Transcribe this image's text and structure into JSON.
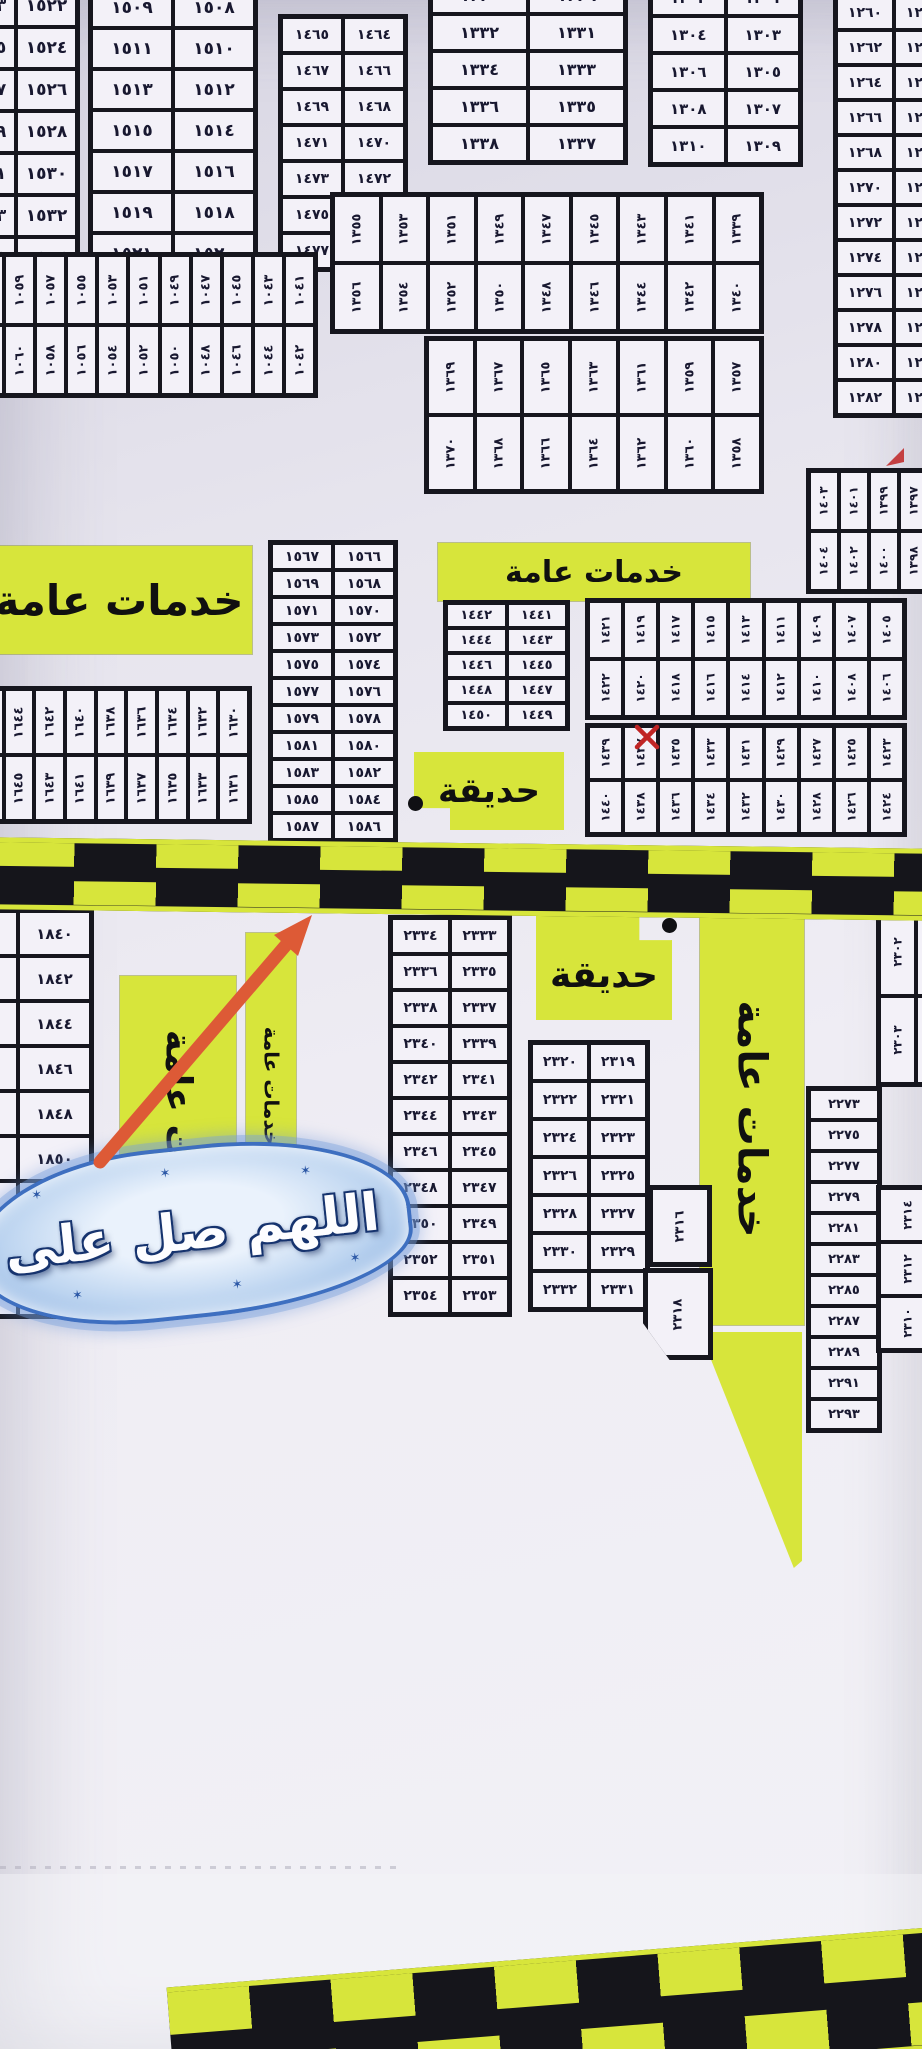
{
  "labels": {
    "public_services": "خدمات عامة",
    "garden": "حديقة",
    "calligraphy": "اللهم صل على"
  },
  "colors": {
    "paper": "#e8e6ef",
    "cell": "#f3f1f8",
    "line": "#16161e",
    "highlight": "#d7e53b",
    "road": "#15151b",
    "arrow": "#dd5a36",
    "red_mark": "#c02525",
    "calligraphy_blue": "#3e6fc0"
  },
  "plots": {
    "b1522": {
      "rows": [
        [
          "١٥٢٣",
          "١٥٢٢"
        ],
        [
          "١٥٢٥",
          "١٥٢٤"
        ],
        [
          "١٥٢٧",
          "١٥٢٦"
        ],
        [
          "١٥٢٩",
          "١٥٢٨"
        ],
        [
          "١٥٣١",
          "١٥٣٠"
        ],
        [
          "١٥٣٣",
          "١٥٣٢"
        ],
        [
          "١٥٣٥",
          "١٥٣٤"
        ]
      ]
    },
    "b1508": {
      "rows": [
        [
          "١٥٠٩",
          "١٥٠٨"
        ],
        [
          "١٥١١",
          "١٥١٠"
        ],
        [
          "١٥١٣",
          "١٥١٢"
        ],
        [
          "١٥١٥",
          "١٥١٤"
        ],
        [
          "١٥١٧",
          "١٥١٦"
        ],
        [
          "١٥١٩",
          "١٥١٨"
        ],
        [
          "١٥٢١",
          "١٥٢٠"
        ]
      ]
    },
    "b1464": {
      "rows": [
        [
          "١٤٦٥",
          "١٤٦٤"
        ],
        [
          "١٤٦٧",
          "١٤٦٦"
        ],
        [
          "١٤٦٩",
          "١٤٦٨"
        ],
        [
          "١٤٧١",
          "١٤٧٠"
        ],
        [
          "١٤٧٣",
          "١٤٧٢"
        ],
        [
          "١٤٧٥",
          "١٤٧٤"
        ],
        [
          "١٤٧٧",
          "١٤٧٦"
        ]
      ]
    },
    "b1329": {
      "rows": [
        [
          "١٣٣٠",
          "١٣٢٩"
        ],
        [
          "١٣٣٢",
          "١٣٣١"
        ],
        [
          "١٣٣٤",
          "١٣٣٣"
        ],
        [
          "١٣٣٦",
          "١٣٣٥"
        ],
        [
          "١٣٣٨",
          "١٣٣٧"
        ]
      ]
    },
    "b1301": {
      "rows": [
        [
          "١٣٠٢",
          "١٣٠١"
        ],
        [
          "١٣٠٤",
          "١٣٠٣"
        ],
        [
          "١٣٠٦",
          "١٣٠٥"
        ],
        [
          "١٣٠٨",
          "١٣٠٧"
        ],
        [
          "١٣١٠",
          "١٣٠٩"
        ]
      ]
    },
    "b1259": {
      "rows": [
        [
          "١٢٦٠",
          "١٢٥٩"
        ],
        [
          "١٢٦٢",
          "١٢٦١"
        ],
        [
          "١٢٦٤",
          "١٢٦٣"
        ],
        [
          "١٢٦٦",
          "١٢٦٥"
        ],
        [
          "١٢٦٨",
          "١٢٦٧"
        ],
        [
          "١٢٧٠",
          "١٢٦٩"
        ],
        [
          "١٢٧٢",
          "١٢٧١"
        ],
        [
          "١٢٧٤",
          "١٢٧٣"
        ],
        [
          "١٢٧٦",
          "١٢٧٥"
        ],
        [
          "١٢٧٨",
          "١٢٧٧"
        ],
        [
          "١٢٨٠",
          "١٢٧٩"
        ],
        [
          "١٢٨٢",
          "١٢٨١"
        ]
      ]
    },
    "s1040": {
      "rows": [
        [
          "١٠٦١",
          "١٠٥٩",
          "١٠٥٧",
          "١٠٥٥",
          "١٠٥٣",
          "١٠٥١",
          "١٠٤٩",
          "١٠٤٧",
          "١٠٤٥",
          "١٠٤٣",
          "١٠٤١"
        ],
        [
          "١٠٦٢",
          "١٠٦٠",
          "١٠٥٨",
          "١٠٥٦",
          "١٠٥٤",
          "١٠٥٢",
          "١٠٥٠",
          "١٠٤٨",
          "١٠٤٦",
          "١٠٤٤",
          "١٠٤٢"
        ]
      ]
    },
    "s1339": {
      "rows": [
        [
          "١٣٥٥",
          "١٣٥٣",
          "١٣٥١",
          "١٣٤٩",
          "١٣٤٧",
          "١٣٤٥",
          "١٣٤٣",
          "١٣٤١",
          "١٣٣٩"
        ],
        [
          "١٣٥٦",
          "١٣٥٤",
          "١٣٥٢",
          "١٣٥٠",
          "١٣٤٨",
          "١٣٤٦",
          "١٣٤٤",
          "١٣٤٢",
          "١٣٤٠"
        ]
      ]
    },
    "s1357": {
      "rows": [
        [
          "١٣٦٩",
          "١٣٦٧",
          "١٣٦٥",
          "١٣٦٣",
          "١٣٦١",
          "١٣٥٩",
          "١٣٥٧"
        ],
        [
          "١٣٧٠",
          "١٣٦٨",
          "١٣٦٦",
          "١٣٦٤",
          "١٣٦٢",
          "١٣٦٠",
          "١٣٥٨"
        ]
      ]
    },
    "b1397": {
      "rows": [
        [
          "١٤٠٣",
          "١٤٠١",
          "١٣٩٩",
          "١٣٩٧"
        ],
        [
          "١٤٠٤",
          "١٤٠٢",
          "١٤٠٠",
          "١٣٩٨"
        ]
      ]
    },
    "b1566": {
      "rows": [
        [
          "١٥٦٧",
          "١٥٦٦"
        ],
        [
          "١٥٦٩",
          "١٥٦٨"
        ],
        [
          "١٥٧١",
          "١٥٧٠"
        ],
        [
          "١٥٧٣",
          "١٥٧٢"
        ],
        [
          "١٥٧٥",
          "١٥٧٤"
        ],
        [
          "١٥٧٧",
          "١٥٧٦"
        ],
        [
          "١٥٧٩",
          "١٥٧٨"
        ],
        [
          "١٥٨١",
          "١٥٨٠"
        ],
        [
          "١٥٨٣",
          "١٥٨٢"
        ],
        [
          "١٥٨٥",
          "١٥٨٤"
        ],
        [
          "١٥٨٧",
          "١٥٨٦"
        ]
      ]
    },
    "b1441": {
      "rows": [
        [
          "١٤٤٢",
          "١٤٤١"
        ],
        [
          "١٤٤٤",
          "١٤٤٣"
        ],
        [
          "١٤٤٦",
          "١٤٤٥"
        ],
        [
          "١٤٤٨",
          "١٤٤٧"
        ],
        [
          "١٤٥٠",
          "١٤٤٩"
        ]
      ]
    },
    "s1405": {
      "rows": [
        [
          "١٤٢١",
          "١٤١٩",
          "١٤١٧",
          "١٤١٥",
          "١٤١٣",
          "١٤١١",
          "١٤٠٩",
          "١٤٠٧",
          "١٤٠٥"
        ],
        [
          "١٤٢٢",
          "١٤٢٠",
          "١٤١٨",
          "١٤١٦",
          "١٤١٤",
          "١٤١٢",
          "١٤١٠",
          "١٤٠٨",
          "١٤٠٦"
        ]
      ]
    },
    "s1423": {
      "rows": [
        [
          "١٤٣٩",
          "١٤٣٧",
          "١٤٣٥",
          "١٤٣٣",
          "١٤٣١",
          "١٤٢٩",
          "١٤٢٧",
          "١٤٢٥",
          "١٤٢٣"
        ],
        [
          "١٤٤٠",
          "١٤٣٨",
          "١٤٣٦",
          "١٤٣٤",
          "١٤٣٢",
          "١٤٣٠",
          "١٤٢٨",
          "١٤٢٦",
          "١٤٢٤"
        ]
      ]
    },
    "s1630": {
      "rows": [
        [
          "١٦٤٦",
          "١٦٤٤",
          "١٦٤٢",
          "١٦٤٠",
          "١٦٣٨",
          "١٦٣٦",
          "١٦٣٤",
          "١٦٣٢",
          "١٦٣٠"
        ],
        [
          "١٦٤٧",
          "١٦٤٥",
          "١٦٤٣",
          "١٦٤١",
          "١٦٣٩",
          "١٦٣٧",
          "١٦٣٥",
          "١٦٣٣",
          "١٦٣١"
        ]
      ]
    },
    "b1840": {
      "rows": [
        [
          "١٨٤١",
          "١٨٤٠"
        ],
        [
          "١٨٤٣",
          "١٨٤٢"
        ],
        [
          "١٨٤٥",
          "١٨٤٤"
        ],
        [
          "١٨٤٧",
          "١٨٤٦"
        ],
        [
          "١٨٤٩",
          "١٨٤٨"
        ],
        [
          "١٨٥١",
          "١٨٥٠"
        ],
        [
          "١٨٥٣",
          "١٨٥٢"
        ],
        [
          "١٨٥٥",
          "١٨٥٤"
        ],
        [
          "١٨٥٧",
          "١٨٥٦"
        ]
      ]
    },
    "b2333": {
      "rows": [
        [
          "٢٣٣٤",
          "٢٣٣٣"
        ],
        [
          "٢٣٣٦",
          "٢٣٣٥"
        ],
        [
          "٢٣٣٨",
          "٢٣٣٧"
        ],
        [
          "٢٣٤٠",
          "٢٣٣٩"
        ],
        [
          "٢٣٤٢",
          "٢٣٤١"
        ],
        [
          "٢٣٤٤",
          "٢٣٤٣"
        ],
        [
          "٢٣٤٦",
          "٢٣٤٥"
        ],
        [
          "٢٣٤٨",
          "٢٣٤٧"
        ],
        [
          "٢٣٥٠",
          "٢٣٤٩"
        ],
        [
          "٢٣٥٢",
          "٢٣٥١"
        ],
        [
          "٢٣٥٤",
          "٢٣٥٣"
        ]
      ]
    },
    "b2319": {
      "rows": [
        [
          "٢٣٢٠",
          "٢٣١٩"
        ],
        [
          "٢٣٢٢",
          "٢٣٢١"
        ],
        [
          "٢٣٢٤",
          "٢٣٢٣"
        ],
        [
          "٢٣٢٦",
          "٢٣٢٥"
        ],
        [
          "٢٣٢٨",
          "٢٣٢٧"
        ],
        [
          "٢٣٣٠",
          "٢٣٢٩"
        ],
        [
          "٢٣٣٢",
          "٢٣٣١"
        ]
      ]
    },
    "c2273": {
      "cells": [
        "٢٢٧٣",
        "٢٢٧٥",
        "٢٢٧٧",
        "٢٢٧٩",
        "٢٢٨١",
        "٢٢٨٣",
        "٢٢٨٥",
        "٢٢٨٧",
        "٢٢٨٩",
        "٢٢٩١",
        "٢٢٩٣"
      ]
    },
    "s2300": {
      "rows": [
        [
          "٢٣٠٢",
          "٢٣٠٠"
        ],
        [
          "٢٣٠٣",
          "٢٣٠١"
        ]
      ]
    },
    "s2310": {
      "cells": [
        "٢٣١٤",
        "٢٣١٢",
        "٢٣١٠"
      ]
    },
    "p2316": {
      "cells": [
        "٢٣١٦"
      ]
    },
    "p2318": {
      "cells": [
        "٢٣١٨"
      ]
    }
  }
}
